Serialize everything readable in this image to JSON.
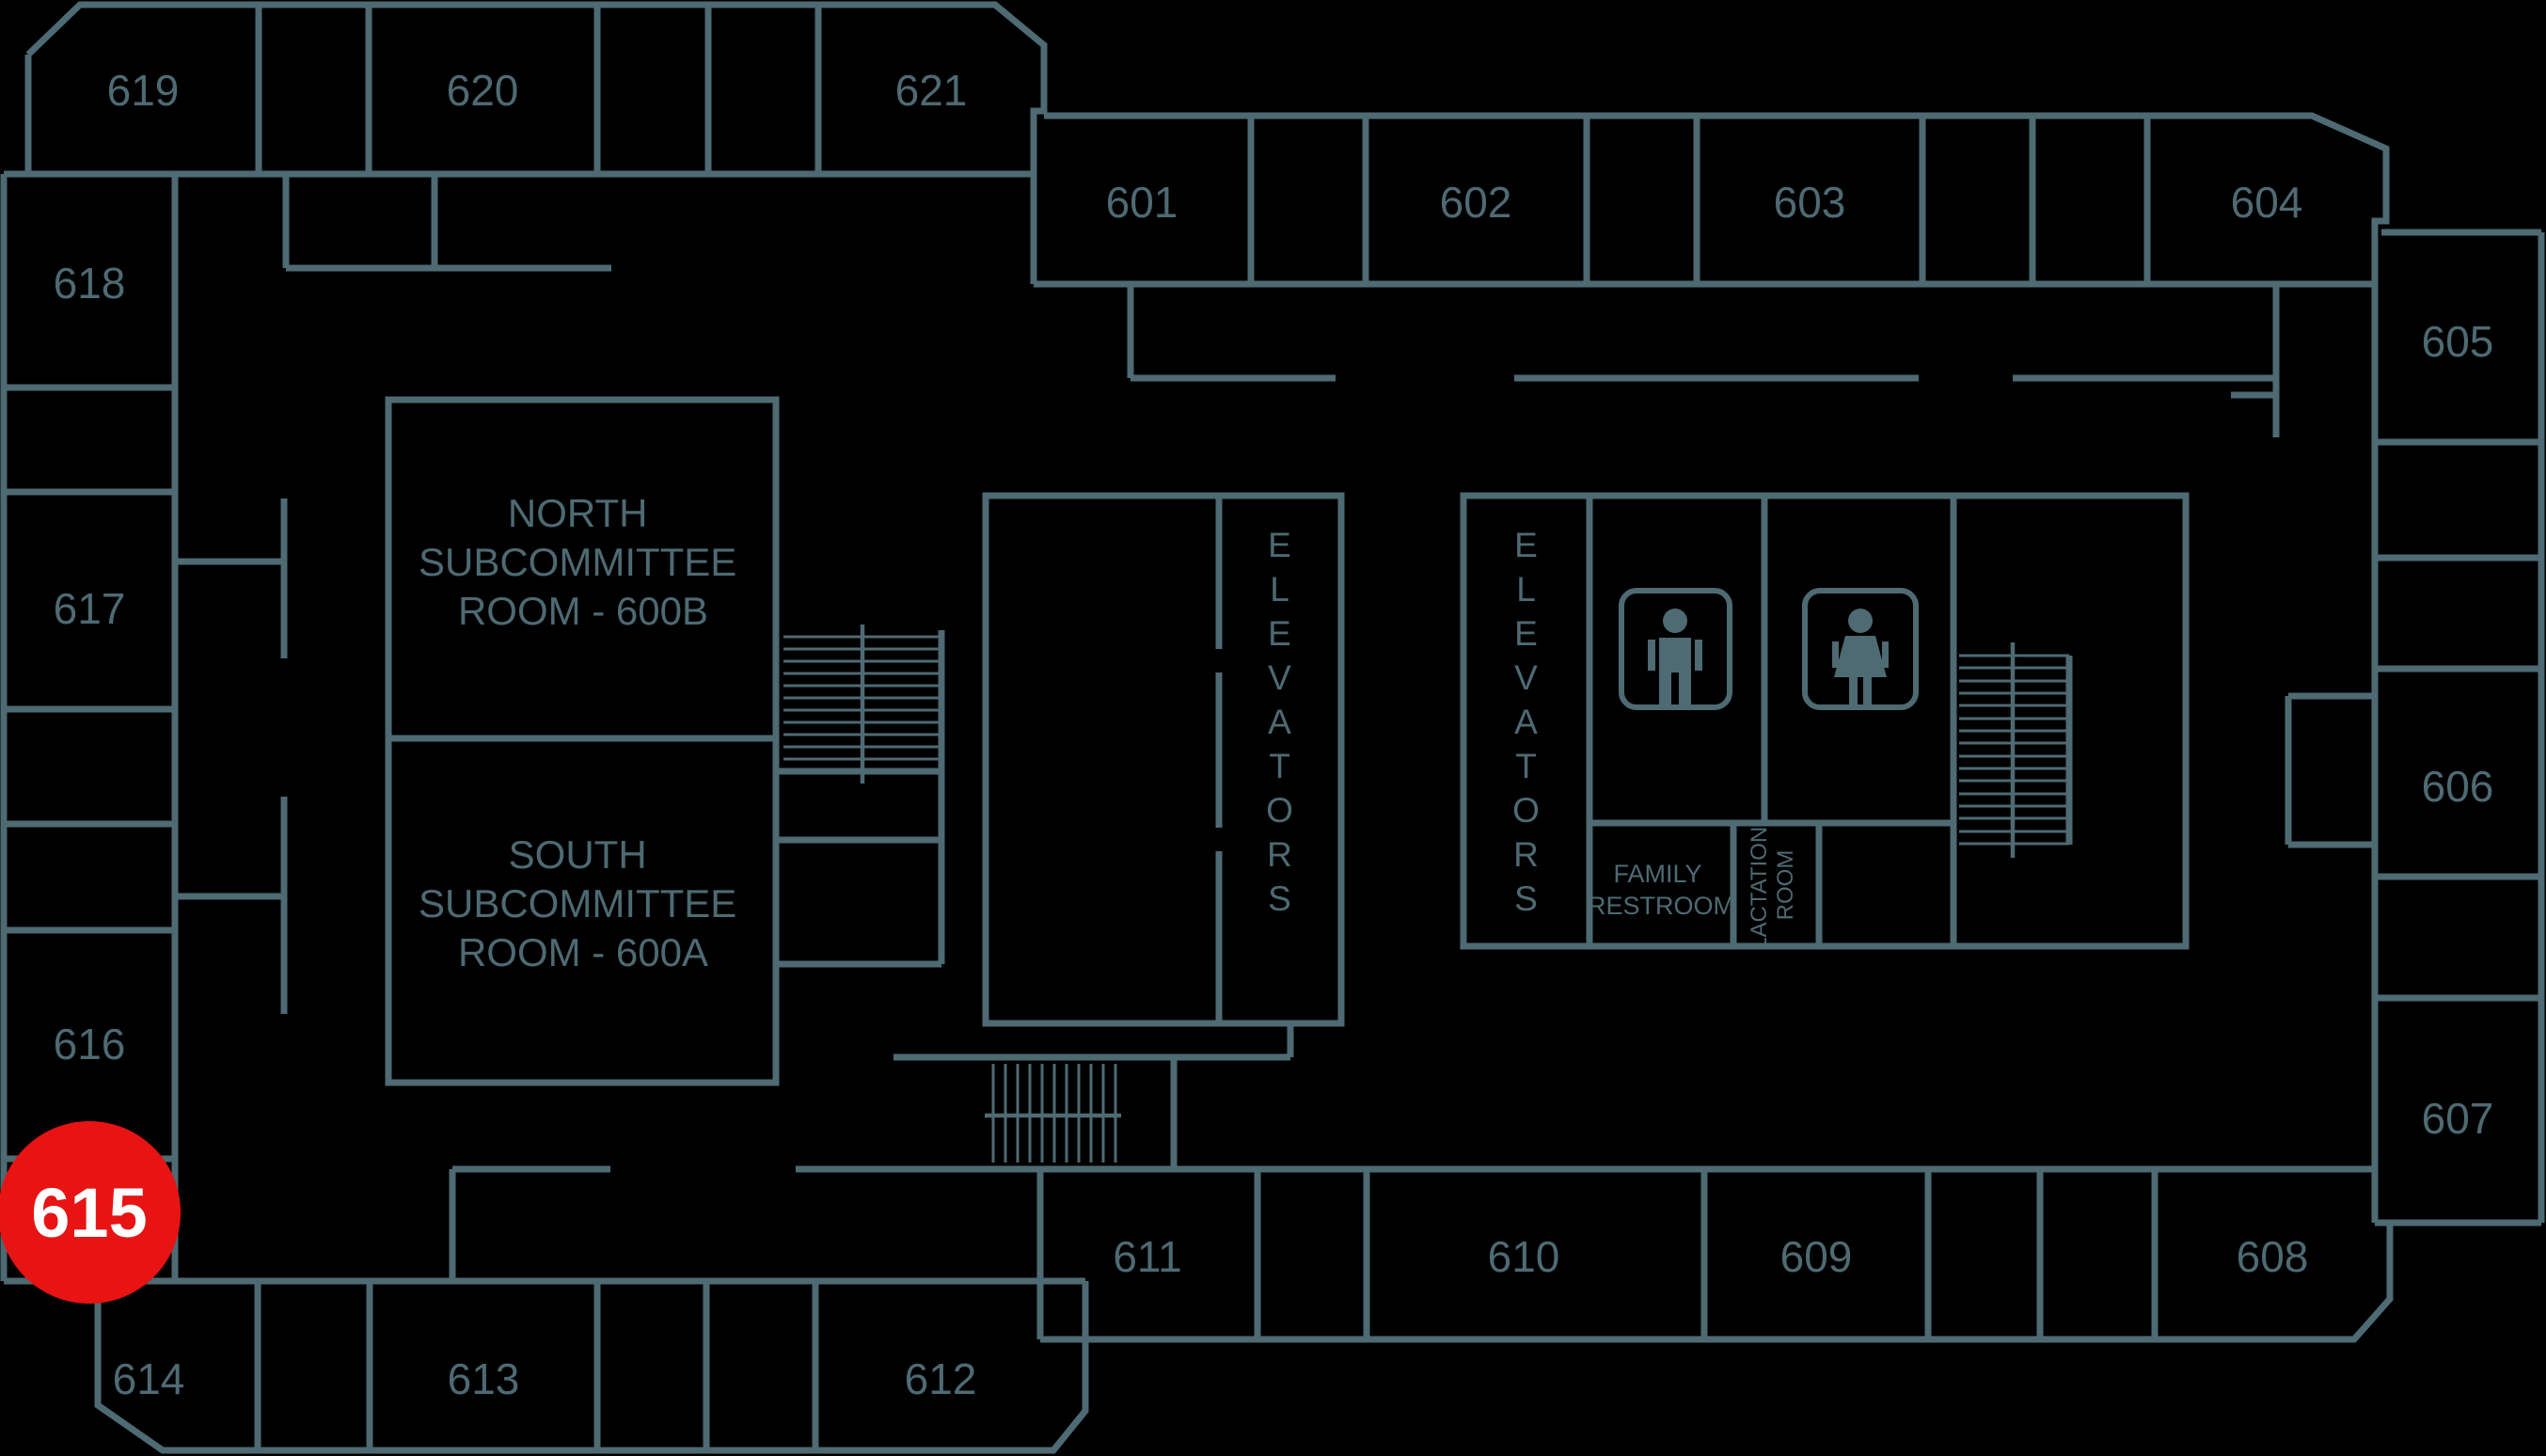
{
  "colors": {
    "wall": "#4e6a73",
    "background": "#000000",
    "highlight": "#e81313",
    "highlight_text": "#ffffff"
  },
  "rooms": {
    "601": "601",
    "602": "602",
    "603": "603",
    "604": "604",
    "605": "605",
    "606": "606",
    "607": "607",
    "608": "608",
    "609": "609",
    "610": "610",
    "611": "611",
    "612": "612",
    "613": "613",
    "614": "614",
    "615": "615",
    "616": "616",
    "617": "617",
    "618": "618",
    "619": "619",
    "620": "620",
    "621": "621"
  },
  "labels": {
    "north_room": {
      "line1": "NORTH",
      "line2": "SUBCOMMITTEE",
      "line3": "ROOM - 600B"
    },
    "south_room": {
      "line1": "SOUTH",
      "line2": "SUBCOMMITTEE",
      "line3": "ROOM - 600A"
    },
    "family_restroom": {
      "line1": "FAMILY",
      "line2": "RESTROOM"
    },
    "lactation_room": {
      "line1": "LACTATION",
      "line2": "ROOM"
    },
    "elevators_left": "ELEVATORS",
    "elevators_right": "ELEVATORS"
  },
  "highlight": {
    "room": "615"
  },
  "icons": {
    "men": "men-restroom-icon",
    "women": "women-restroom-icon"
  }
}
